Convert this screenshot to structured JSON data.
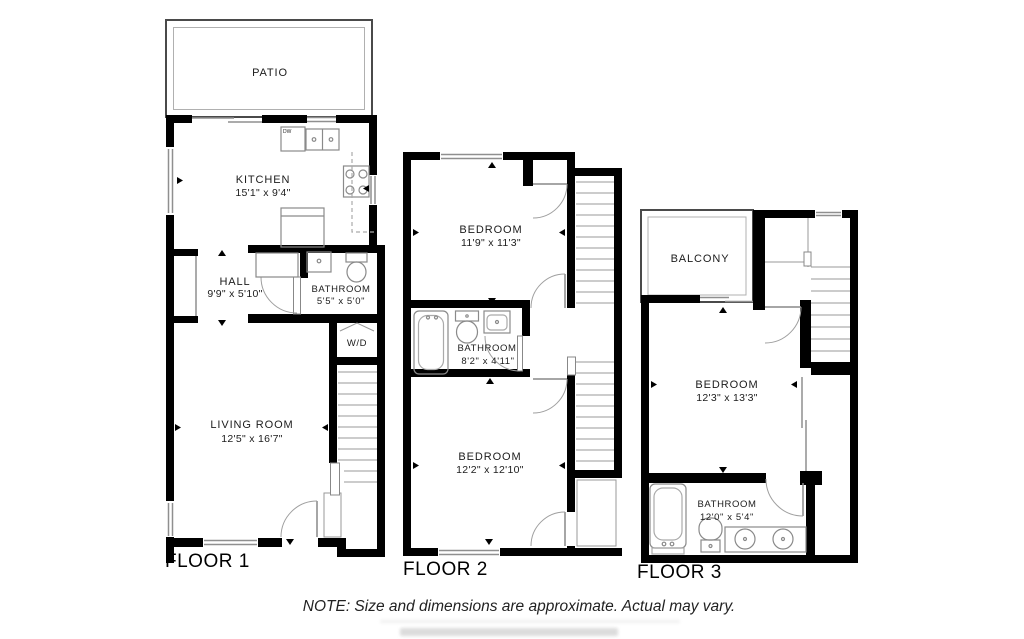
{
  "note": "NOTE: Size and dimensions are approximate. Actual may vary.",
  "colors": {
    "wall": "#000000",
    "thin_line": "#9a9a9a",
    "background": "#ffffff"
  },
  "floors": [
    {
      "label": "FLOOR 1",
      "rooms": {
        "patio": {
          "name": "PATIO"
        },
        "kitchen": {
          "name": "KITCHEN",
          "dims": "15'1\" x 9'4\""
        },
        "hall": {
          "name": "HALL",
          "dims": "9'9\" x 5'10\""
        },
        "bathroom": {
          "name": "BATHROOM",
          "dims": "5'5\" x 5'0\""
        },
        "wd": {
          "name": "W/D"
        },
        "dw": {
          "name": "DW"
        },
        "living": {
          "name": "LIVING ROOM",
          "dims": "12'5\" x 16'7\""
        }
      }
    },
    {
      "label": "FLOOR 2",
      "rooms": {
        "bedroom1": {
          "name": "BEDROOM",
          "dims": "11'9\" x 11'3\""
        },
        "bathroom": {
          "name": "BATHROOM",
          "dims": "8'2\" x 4'11\""
        },
        "bedroom2": {
          "name": "BEDROOM",
          "dims": "12'2\" x 12'10\""
        }
      }
    },
    {
      "label": "FLOOR 3",
      "rooms": {
        "balcony": {
          "name": "BALCONY"
        },
        "bedroom": {
          "name": "BEDROOM",
          "dims": "12'3\" x 13'3\""
        },
        "bathroom": {
          "name": "BATHROOM",
          "dims": "12'0\" x 5'4\""
        }
      }
    }
  ]
}
